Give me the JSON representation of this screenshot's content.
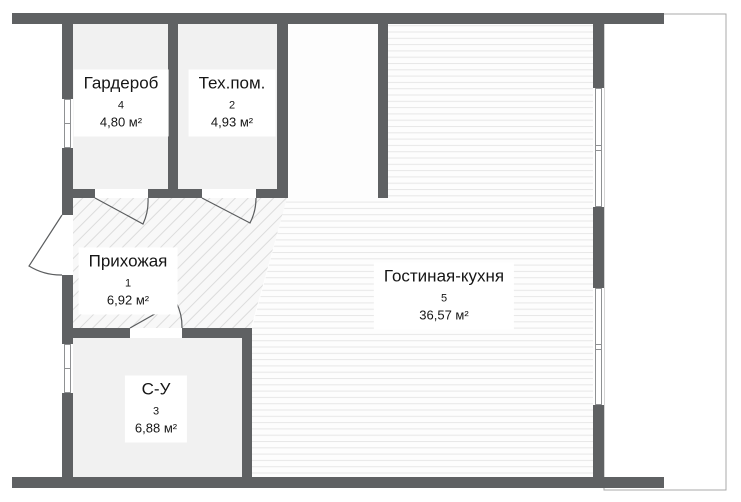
{
  "plan": {
    "rooms": [
      {
        "name": "Гардероб",
        "number": "4",
        "area": "4,80 м²"
      },
      {
        "name": "Тех.пом.",
        "number": "2",
        "area": "4,93 м²"
      },
      {
        "name": "Прихожая",
        "number": "1",
        "area": "6,92 м²"
      },
      {
        "name": "С-У",
        "number": "3",
        "area": "6,88 м²"
      },
      {
        "name": "Гостиная-кухня",
        "number": "5",
        "area": "36,57 м²"
      }
    ],
    "colors": {
      "wall": "#5f6163",
      "room_fill": "#f1f1f1",
      "hatch_line": "#dcdcdc",
      "stripe_line": "#e8e8e8",
      "window_frame": "#8f9193",
      "door_stroke": "#5b5d5f",
      "balcony_outline": "#a9a9a9"
    }
  }
}
